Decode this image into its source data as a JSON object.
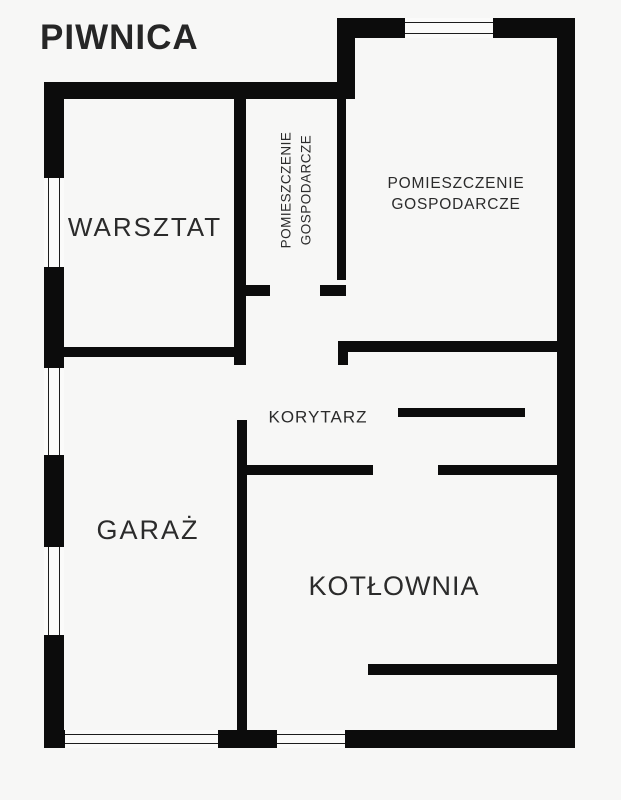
{
  "title": "PIWNICA",
  "colors": {
    "background": "#f7f7f6",
    "wall": "#0c0c0c",
    "text": "#2b2b2b",
    "window_line": "#1d1d1d"
  },
  "plan": {
    "walls": [
      {
        "name": "outer-wall-top-left",
        "rect": [
          44,
          82,
          311,
          17
        ]
      },
      {
        "name": "outer-wall-step",
        "rect": [
          337,
          18,
          18,
          81
        ]
      },
      {
        "name": "outer-wall-top-right-a",
        "rect": [
          337,
          18,
          68,
          20
        ]
      },
      {
        "name": "outer-wall-top-right-b",
        "rect": [
          493,
          18,
          82,
          20
        ]
      },
      {
        "name": "outer-wall-right",
        "rect": [
          557,
          18,
          18,
          730
        ]
      },
      {
        "name": "outer-wall-bottom-corner",
        "rect": [
          44,
          730,
          21,
          18
        ]
      },
      {
        "name": "outer-wall-bottom-mid",
        "rect": [
          218,
          730,
          59,
          18
        ]
      },
      {
        "name": "outer-wall-bottom-right",
        "rect": [
          345,
          730,
          230,
          18
        ]
      },
      {
        "name": "outer-wall-left-a",
        "rect": [
          44,
          82,
          20,
          96
        ]
      },
      {
        "name": "outer-wall-left-b",
        "rect": [
          44,
          267,
          20,
          101
        ]
      },
      {
        "name": "outer-wall-left-c",
        "rect": [
          44,
          455,
          20,
          92
        ]
      },
      {
        "name": "outer-wall-left-d",
        "rect": [
          44,
          635,
          20,
          113
        ]
      },
      {
        "name": "wall-warsztat-right",
        "rect": [
          234,
          99,
          12,
          266
        ]
      },
      {
        "name": "wall-warsztat-bottom",
        "rect": [
          64,
          347,
          182,
          10
        ]
      },
      {
        "name": "wall-small-room-bottom-left",
        "rect": [
          234,
          285,
          36,
          11
        ]
      },
      {
        "name": "wall-small-room-bottom-right",
        "rect": [
          320,
          285,
          26,
          11
        ]
      },
      {
        "name": "wall-bigroom-left",
        "rect": [
          337,
          99,
          9,
          181
        ]
      },
      {
        "name": "wall-bigroom-bottom",
        "rect": [
          338,
          341,
          219,
          11
        ]
      },
      {
        "name": "wall-bigroom-bottom-tail",
        "rect": [
          338,
          341,
          10,
          24
        ]
      },
      {
        "name": "wall-corridor-partition",
        "rect": [
          398,
          408,
          127,
          9
        ]
      },
      {
        "name": "wall-corridor-bottom-left",
        "rect": [
          237,
          465,
          136,
          10
        ]
      },
      {
        "name": "wall-corridor-bottom-right",
        "rect": [
          438,
          465,
          119,
          10
        ]
      },
      {
        "name": "wall-garage-divider",
        "rect": [
          237,
          420,
          10,
          310
        ]
      },
      {
        "name": "wall-kotlownia-inner",
        "rect": [
          368,
          664,
          189,
          11
        ]
      }
    ],
    "windows": [
      {
        "name": "window-left-upper",
        "rect": [
          44,
          178,
          20,
          89
        ],
        "orientation": "v"
      },
      {
        "name": "window-left-middle",
        "rect": [
          44,
          368,
          20,
          87
        ],
        "orientation": "v"
      },
      {
        "name": "window-left-lower",
        "rect": [
          44,
          547,
          20,
          88
        ],
        "orientation": "v"
      },
      {
        "name": "window-top",
        "rect": [
          405,
          18,
          88,
          20
        ],
        "orientation": "h"
      },
      {
        "name": "garage-door-opening",
        "rect": [
          65,
          730,
          153,
          18
        ],
        "orientation": "h"
      },
      {
        "name": "bottom-opening",
        "rect": [
          277,
          730,
          68,
          18
        ],
        "orientation": "h"
      }
    ],
    "labels": [
      {
        "name": "room-label-warsztat",
        "lines": [
          "WARSZTAT"
        ],
        "cx": 145,
        "cy": 227,
        "size": 26,
        "spacing": 2,
        "rotate": 0
      },
      {
        "name": "room-label-pomieszczenie-gospodarcze-small",
        "lines": [
          "POMIESZCZENIE",
          "GOSPODARCZE"
        ],
        "cx": 296,
        "cy": 190,
        "size": 13.5,
        "spacing": 0.5,
        "rotate": -90,
        "lineHeight": 1.45
      },
      {
        "name": "room-label-pomieszczenie-gospodarcze-large",
        "lines": [
          "POMIESZCZENIE",
          "GOSPODARCZE"
        ],
        "cx": 456,
        "cy": 195,
        "size": 15.5,
        "spacing": 0.8,
        "rotate": 0,
        "lineHeight": 1.35
      },
      {
        "name": "room-label-korytarz",
        "lines": [
          "KORYTARZ"
        ],
        "cx": 318,
        "cy": 417,
        "size": 17,
        "spacing": 1,
        "rotate": 0
      },
      {
        "name": "room-label-garaz",
        "lines": [
          "GARAŻ"
        ],
        "cx": 148,
        "cy": 531,
        "size": 27,
        "spacing": 2,
        "rotate": 0
      },
      {
        "name": "room-label-kotlownia",
        "lines": [
          "KOTŁOWNIA"
        ],
        "cx": 394,
        "cy": 587,
        "size": 27,
        "spacing": 1,
        "rotate": 0
      }
    ]
  }
}
